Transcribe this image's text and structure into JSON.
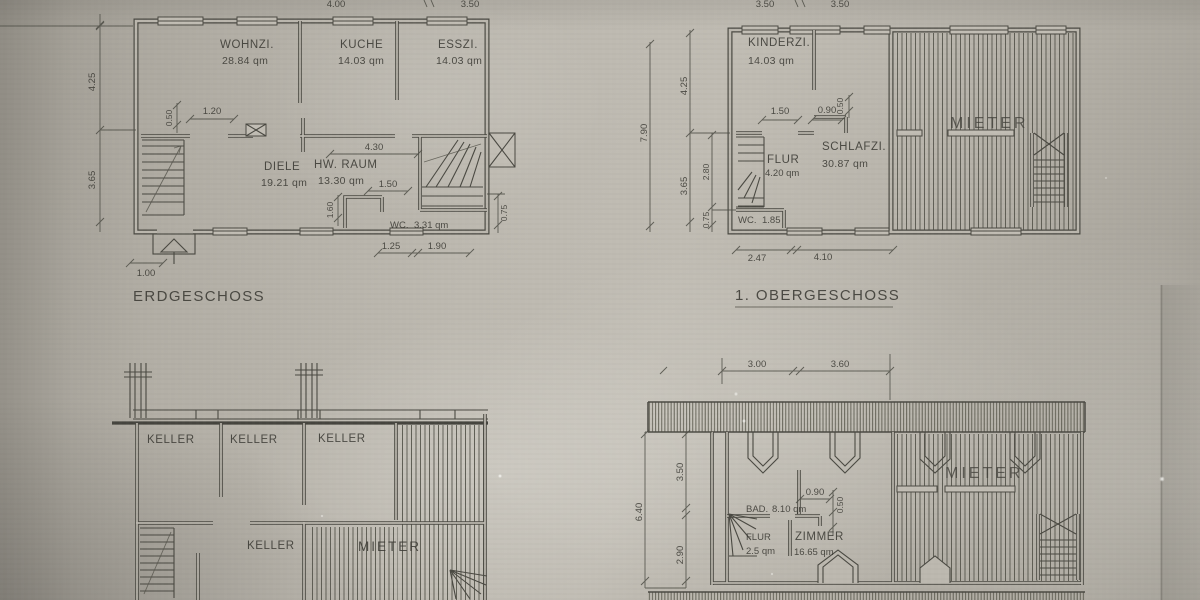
{
  "photo": {
    "paper_color": "#bab6ad",
    "line_color": "#4a4942",
    "text_color": "#3b3a34"
  },
  "plans": {
    "erdgeschoss": {
      "title": "ERDGESCHOSS",
      "rooms": {
        "wohnzimmer": {
          "name": "WOHNZI.",
          "area": "28.84 qm"
        },
        "kueche": {
          "name": "KÜCHE",
          "area": "14.03 qm"
        },
        "esszimmer": {
          "name": "ESSZI.",
          "area": "14.03 qm"
        },
        "diele": {
          "name": "DIELE",
          "area": "19.21 qm"
        },
        "hwraum": {
          "name": "HW. RAUM",
          "area": "13.30 qm"
        },
        "wc": {
          "name": "WC.",
          "area": "3.31 qm"
        }
      },
      "dims": {
        "left_upper": "4.25",
        "left_lower": "3.65",
        "niche_depth": "0.50",
        "door_width": "1.20",
        "diele_width": "4.30",
        "opening": "1.50",
        "wc_width": "1.60",
        "right_lower": "0.75",
        "entry_width": "1.00",
        "bottom_a": "1.25",
        "bottom_b": "1.90",
        "top_cut_a": "4.00",
        "top_cut_b": "3.50"
      }
    },
    "obergeschoss": {
      "title": "1. OBERGESCHOSS",
      "rooms": {
        "kinderzimmer": {
          "name": "KINDERZI.",
          "area": "14.03 qm"
        },
        "schlafzimmer": {
          "name": "SCHLAFZI.",
          "area": "30.87 qm"
        },
        "flur": {
          "name": "FLUR",
          "area": "4.20 qm"
        },
        "wc": {
          "name": "WC.",
          "area": "1.85"
        },
        "mieter": {
          "name": "MIETER"
        }
      },
      "dims": {
        "total_left": "7.90",
        "left_upper": "4.25",
        "left_lower": "3.65",
        "inner_upper": "2.80",
        "inner_lower": "0.75",
        "door": "1.50",
        "closet_w": "0.90",
        "closet_d": "0.50",
        "bottom_a": "2.47",
        "bottom_b": "4.10",
        "top_cut_a": "3.50",
        "top_cut_b": "3.50"
      }
    },
    "keller": {
      "rooms": {
        "keller1": {
          "name": "KELLER"
        },
        "keller2": {
          "name": "KELLER"
        },
        "keller3": {
          "name": "KELLER"
        },
        "keller4": {
          "name": "KELLER"
        },
        "mieter": {
          "name": "MIETER"
        }
      }
    },
    "dachgeschoss": {
      "rooms": {
        "bad": {
          "name": "BAD.",
          "area": "8.10 qm"
        },
        "flur": {
          "name": "FLUR",
          "area": "2.5 qm"
        },
        "zimmer": {
          "name": "ZIMMER",
          "area": "16.65 qm"
        },
        "mieter": {
          "name": "MIETER"
        }
      },
      "dims": {
        "top_a": "3.00",
        "top_b": "3.60",
        "left_upper": "3.50",
        "left_lower": "2.90",
        "total_left": "6.40",
        "closet_w": "0.90",
        "closet_d": "0.50"
      }
    }
  }
}
